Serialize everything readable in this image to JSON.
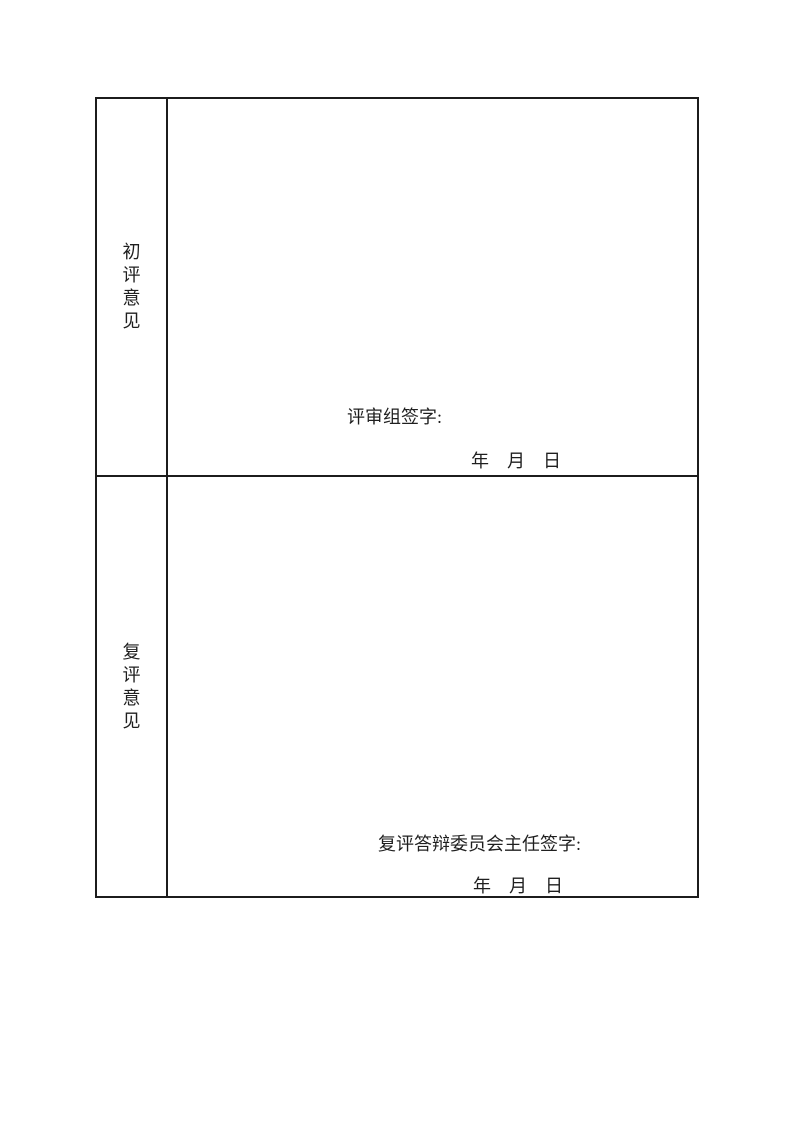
{
  "page": {
    "background": "#ffffff",
    "border_color": "#1c1c1c",
    "text_color": "#1f1f1f"
  },
  "table": {
    "rows": [
      {
        "label": "初评意见",
        "signature_label": "评审组签字:",
        "date_line": "年　月　日"
      },
      {
        "label": "复评意见",
        "signature_label": "复评答辩委员会主任签字:",
        "date_line": "年　月　日"
      }
    ]
  }
}
